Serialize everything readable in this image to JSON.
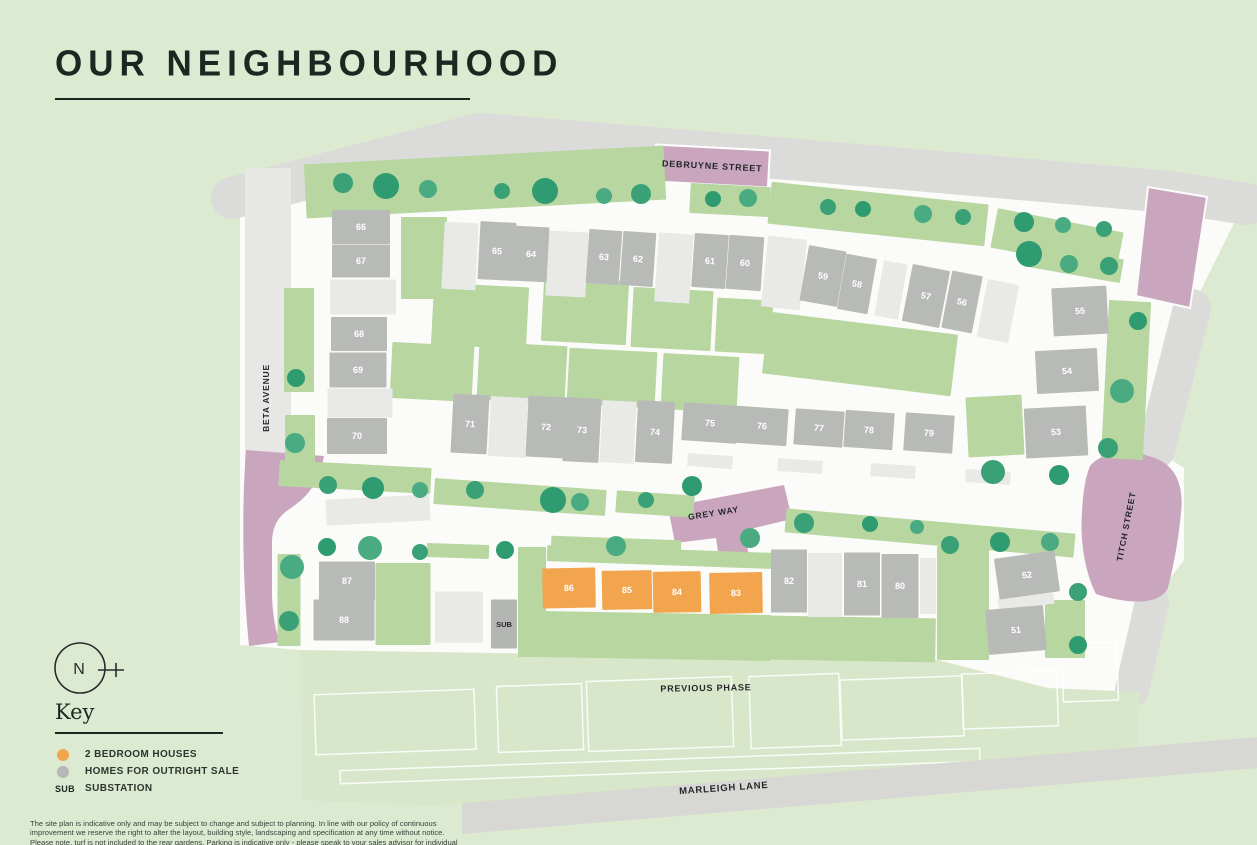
{
  "page": {
    "title": "OUR NEIGHBOURHOOD"
  },
  "north": {
    "label": "N"
  },
  "key": {
    "heading": "Key",
    "items": [
      {
        "id": "2bed",
        "label": "2 BEDROOM HOUSES",
        "swatch": "#f3a54e"
      },
      {
        "id": "outright",
        "label": "HOMES FOR OUTRIGHT SALE",
        "swatch": "#b5b8b6"
      },
      {
        "id": "substation",
        "label": "SUBSTATION",
        "swatch_text": "SUB"
      }
    ]
  },
  "disclaimer": "The site plan is indicative only and may be subject to change and subject to planning. In line with our policy of continuous improvement we reserve the right to alter the layout, building style, landscaping and specification at any time without notice. Please note, turf is not included to the rear gardens. Parking is indicative only - please speak to your sales advisor for individual plot layouts.",
  "map": {
    "colors": {
      "two_bed_plot": "#f3a54e",
      "outright_sale_plot": "#b8bab8",
      "substation": "#b4b6b4",
      "tree": "#3aa177",
      "pink_road": "#c9a6bd",
      "garden": "#b7d6a0"
    },
    "streets": [
      {
        "id": "debruyne-street",
        "label": "DEBRUYNE STREET",
        "x": 712,
        "y": 169,
        "rot": 3,
        "size": 9
      },
      {
        "id": "beta-avenue",
        "label": "BETA AVENUE",
        "x": 269,
        "y": 398,
        "rot": -90,
        "size": 8.5
      },
      {
        "id": "grey-way",
        "label": "GREY WAY",
        "x": 714,
        "y": 516,
        "rot": -9,
        "size": 8.5
      },
      {
        "id": "titch-street",
        "label": "TITCH STREET",
        "x": 1129,
        "y": 527,
        "rot": -79,
        "size": 8.5
      },
      {
        "id": "marleigh-lane",
        "label": "MARLEIGH LANE",
        "x": 724,
        "y": 791,
        "rot": -4,
        "size": 9.5
      },
      {
        "id": "previous-phase",
        "label": "PREVIOUS PHASE",
        "x": 706,
        "y": 691,
        "rot": -1,
        "size": 9
      }
    ],
    "plots": [
      {
        "n": "66",
        "t": "sale",
        "x": 361,
        "y": 227,
        "w": 58,
        "h": 34,
        "r": 0
      },
      {
        "n": "67",
        "t": "sale",
        "x": 361,
        "y": 261,
        "w": 58,
        "h": 33,
        "r": 0
      },
      {
        "n": "68",
        "t": "sale",
        "x": 359,
        "y": 334,
        "w": 56,
        "h": 34,
        "r": 0
      },
      {
        "n": "69",
        "t": "sale",
        "x": 358,
        "y": 370,
        "w": 57,
        "h": 35,
        "r": 0
      },
      {
        "n": "70",
        "t": "sale",
        "x": 357,
        "y": 436,
        "w": 60,
        "h": 36,
        "r": 0
      },
      {
        "n": "65",
        "t": "sale",
        "x": 497,
        "y": 251,
        "w": 36,
        "h": 58,
        "r": 3
      },
      {
        "n": "64",
        "t": "sale",
        "x": 531,
        "y": 254,
        "w": 34,
        "h": 55,
        "r": 3
      },
      {
        "n": "63",
        "t": "sale",
        "x": 604,
        "y": 257,
        "w": 33,
        "h": 54,
        "r": 4
      },
      {
        "n": "62",
        "t": "sale",
        "x": 638,
        "y": 259,
        "w": 33,
        "h": 54,
        "r": 4
      },
      {
        "n": "61",
        "t": "sale",
        "x": 710,
        "y": 261,
        "w": 34,
        "h": 54,
        "r": 4
      },
      {
        "n": "60",
        "t": "sale",
        "x": 745,
        "y": 263,
        "w": 35,
        "h": 54,
        "r": 4
      },
      {
        "n": "59",
        "t": "sale",
        "x": 823,
        "y": 276,
        "w": 38,
        "h": 56,
        "r": 10
      },
      {
        "n": "58",
        "t": "sale",
        "x": 857,
        "y": 284,
        "w": 31,
        "h": 56,
        "r": 10
      },
      {
        "n": "57",
        "t": "sale",
        "x": 926,
        "y": 296,
        "w": 38,
        "h": 58,
        "r": 11
      },
      {
        "n": "56",
        "t": "sale",
        "x": 962,
        "y": 302,
        "w": 31,
        "h": 58,
        "r": 11
      },
      {
        "n": "55",
        "t": "sale",
        "x": 1080,
        "y": 311,
        "w": 55,
        "h": 48,
        "r": -3
      },
      {
        "n": "54",
        "t": "sale",
        "x": 1067,
        "y": 371,
        "w": 62,
        "h": 43,
        "r": -3
      },
      {
        "n": "53",
        "t": "sale",
        "x": 1056,
        "y": 432,
        "w": 62,
        "h": 50,
        "r": -3
      },
      {
        "n": "71",
        "t": "sale",
        "x": 470,
        "y": 424,
        "w": 36,
        "h": 59,
        "r": 3
      },
      {
        "n": "72",
        "t": "sale",
        "x": 546,
        "y": 427,
        "w": 38,
        "h": 61,
        "r": 3
      },
      {
        "n": "73",
        "t": "sale",
        "x": 582,
        "y": 430,
        "w": 36,
        "h": 64,
        "r": 3
      },
      {
        "n": "74",
        "t": "sale",
        "x": 655,
        "y": 432,
        "w": 37,
        "h": 62,
        "r": 3
      },
      {
        "n": "75",
        "t": "sale",
        "x": 710,
        "y": 423,
        "w": 55,
        "h": 38,
        "r": 4
      },
      {
        "n": "76",
        "t": "sale",
        "x": 762,
        "y": 426,
        "w": 51,
        "h": 37,
        "r": 4
      },
      {
        "n": "77",
        "t": "sale",
        "x": 819,
        "y": 428,
        "w": 49,
        "h": 36,
        "r": 4
      },
      {
        "n": "78",
        "t": "sale",
        "x": 869,
        "y": 430,
        "w": 49,
        "h": 37,
        "r": 4
      },
      {
        "n": "79",
        "t": "sale",
        "x": 929,
        "y": 433,
        "w": 49,
        "h": 38,
        "r": 4
      },
      {
        "n": "87",
        "t": "sale",
        "x": 347,
        "y": 581,
        "w": 56,
        "h": 39,
        "r": 0
      },
      {
        "n": "88",
        "t": "sale",
        "x": 344,
        "y": 620,
        "w": 61,
        "h": 41,
        "r": 0
      },
      {
        "n": "86",
        "t": "2bed",
        "x": 569,
        "y": 588,
        "w": 53,
        "h": 40,
        "r": -1
      },
      {
        "n": "85",
        "t": "2bed",
        "x": 627,
        "y": 590,
        "w": 50,
        "h": 39,
        "r": -1
      },
      {
        "n": "84",
        "t": "2bed",
        "x": 677,
        "y": 592,
        "w": 48,
        "h": 41,
        "r": -1
      },
      {
        "n": "83",
        "t": "2bed",
        "x": 736,
        "y": 593,
        "w": 53,
        "h": 41,
        "r": -1
      },
      {
        "n": "82",
        "t": "sale",
        "x": 789,
        "y": 581,
        "w": 36,
        "h": 63,
        "r": 0
      },
      {
        "n": "81",
        "t": "sale",
        "x": 862,
        "y": 584,
        "w": 36,
        "h": 63,
        "r": 0
      },
      {
        "n": "80",
        "t": "sale",
        "x": 900,
        "y": 586,
        "w": 37,
        "h": 64,
        "r": 0
      },
      {
        "n": "52",
        "t": "sale",
        "x": 1027,
        "y": 575,
        "w": 61,
        "h": 41,
        "r": -8
      },
      {
        "n": "51",
        "t": "sale",
        "x": 1016,
        "y": 630,
        "w": 58,
        "h": 45,
        "r": -5
      },
      {
        "n": "SUB",
        "t": "sub",
        "x": 504,
        "y": 624,
        "w": 26,
        "h": 49,
        "r": 0
      }
    ]
  }
}
